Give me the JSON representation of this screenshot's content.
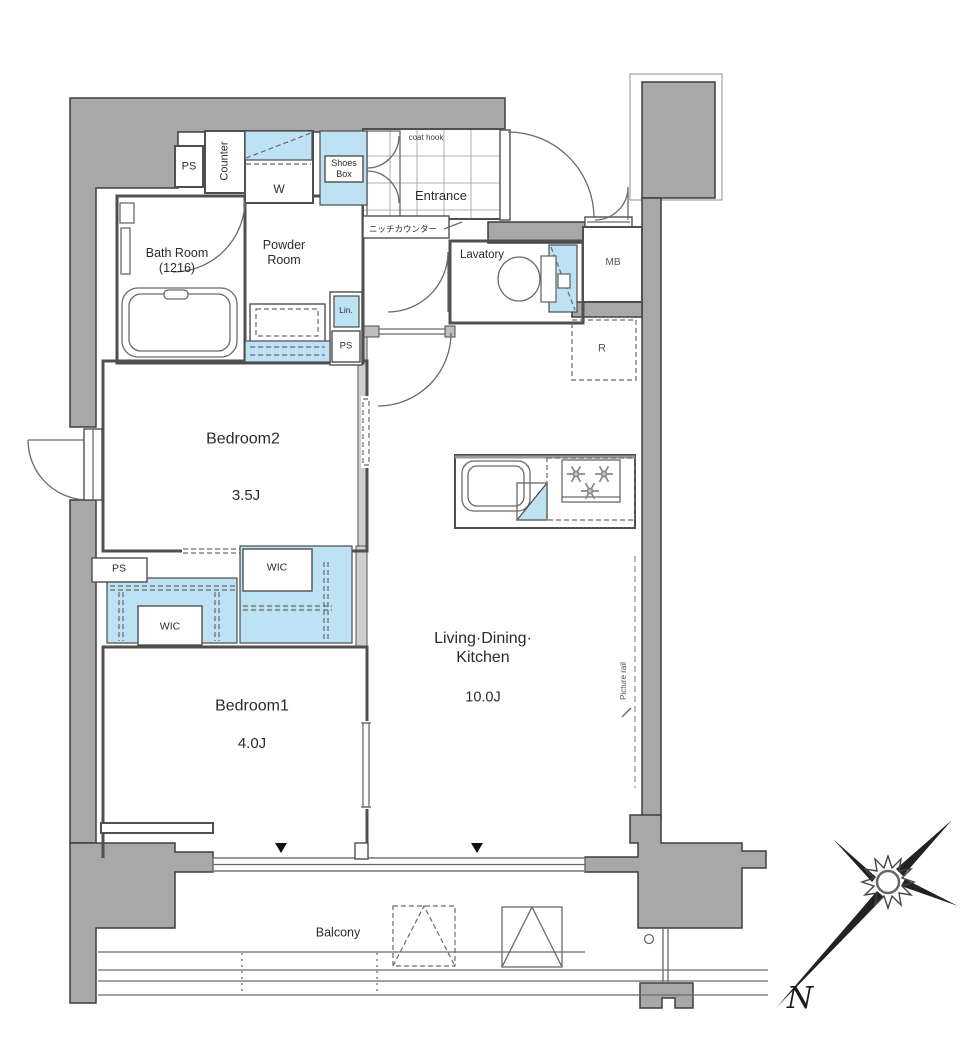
{
  "title": "Apartment Floor Plan",
  "rooms": {
    "entrance": {
      "label": "Entrance"
    },
    "bath": {
      "label": "Bath Room",
      "size": "(1216)"
    },
    "powder": {
      "label": "Powder",
      "label2": "Room"
    },
    "lavatory": {
      "label": "Lavatory"
    },
    "bedroom2": {
      "label": "Bedroom2",
      "area": "3.5J"
    },
    "bedroom1": {
      "label": "Bedroom1",
      "area": "4.0J"
    },
    "ldk": {
      "label": "Living·Dining·",
      "label2": "Kitchen",
      "area": "10.0J"
    },
    "balcony": {
      "label": "Balcony"
    }
  },
  "closets": {
    "wic_left": "WIC",
    "wic_right": "WIC",
    "shoes_line1": "Shoes",
    "shoes_line2": "Box",
    "linen": "Lin."
  },
  "labels": {
    "counter": "Counter",
    "washer": "W",
    "coat_hook": "coat hook",
    "niche_counter": "ニッチカウンター",
    "refrigerator": "R",
    "meter_box": "MB",
    "picture_rail": "Picture rail",
    "ps_top": "PS",
    "ps_mid": "PS",
    "ps_left": "PS"
  },
  "compass": {
    "north": "N"
  },
  "colors": {
    "wall": "#a8a8a8",
    "fixture_blue": "#bce2f3",
    "outline": "#3e3e3e"
  }
}
